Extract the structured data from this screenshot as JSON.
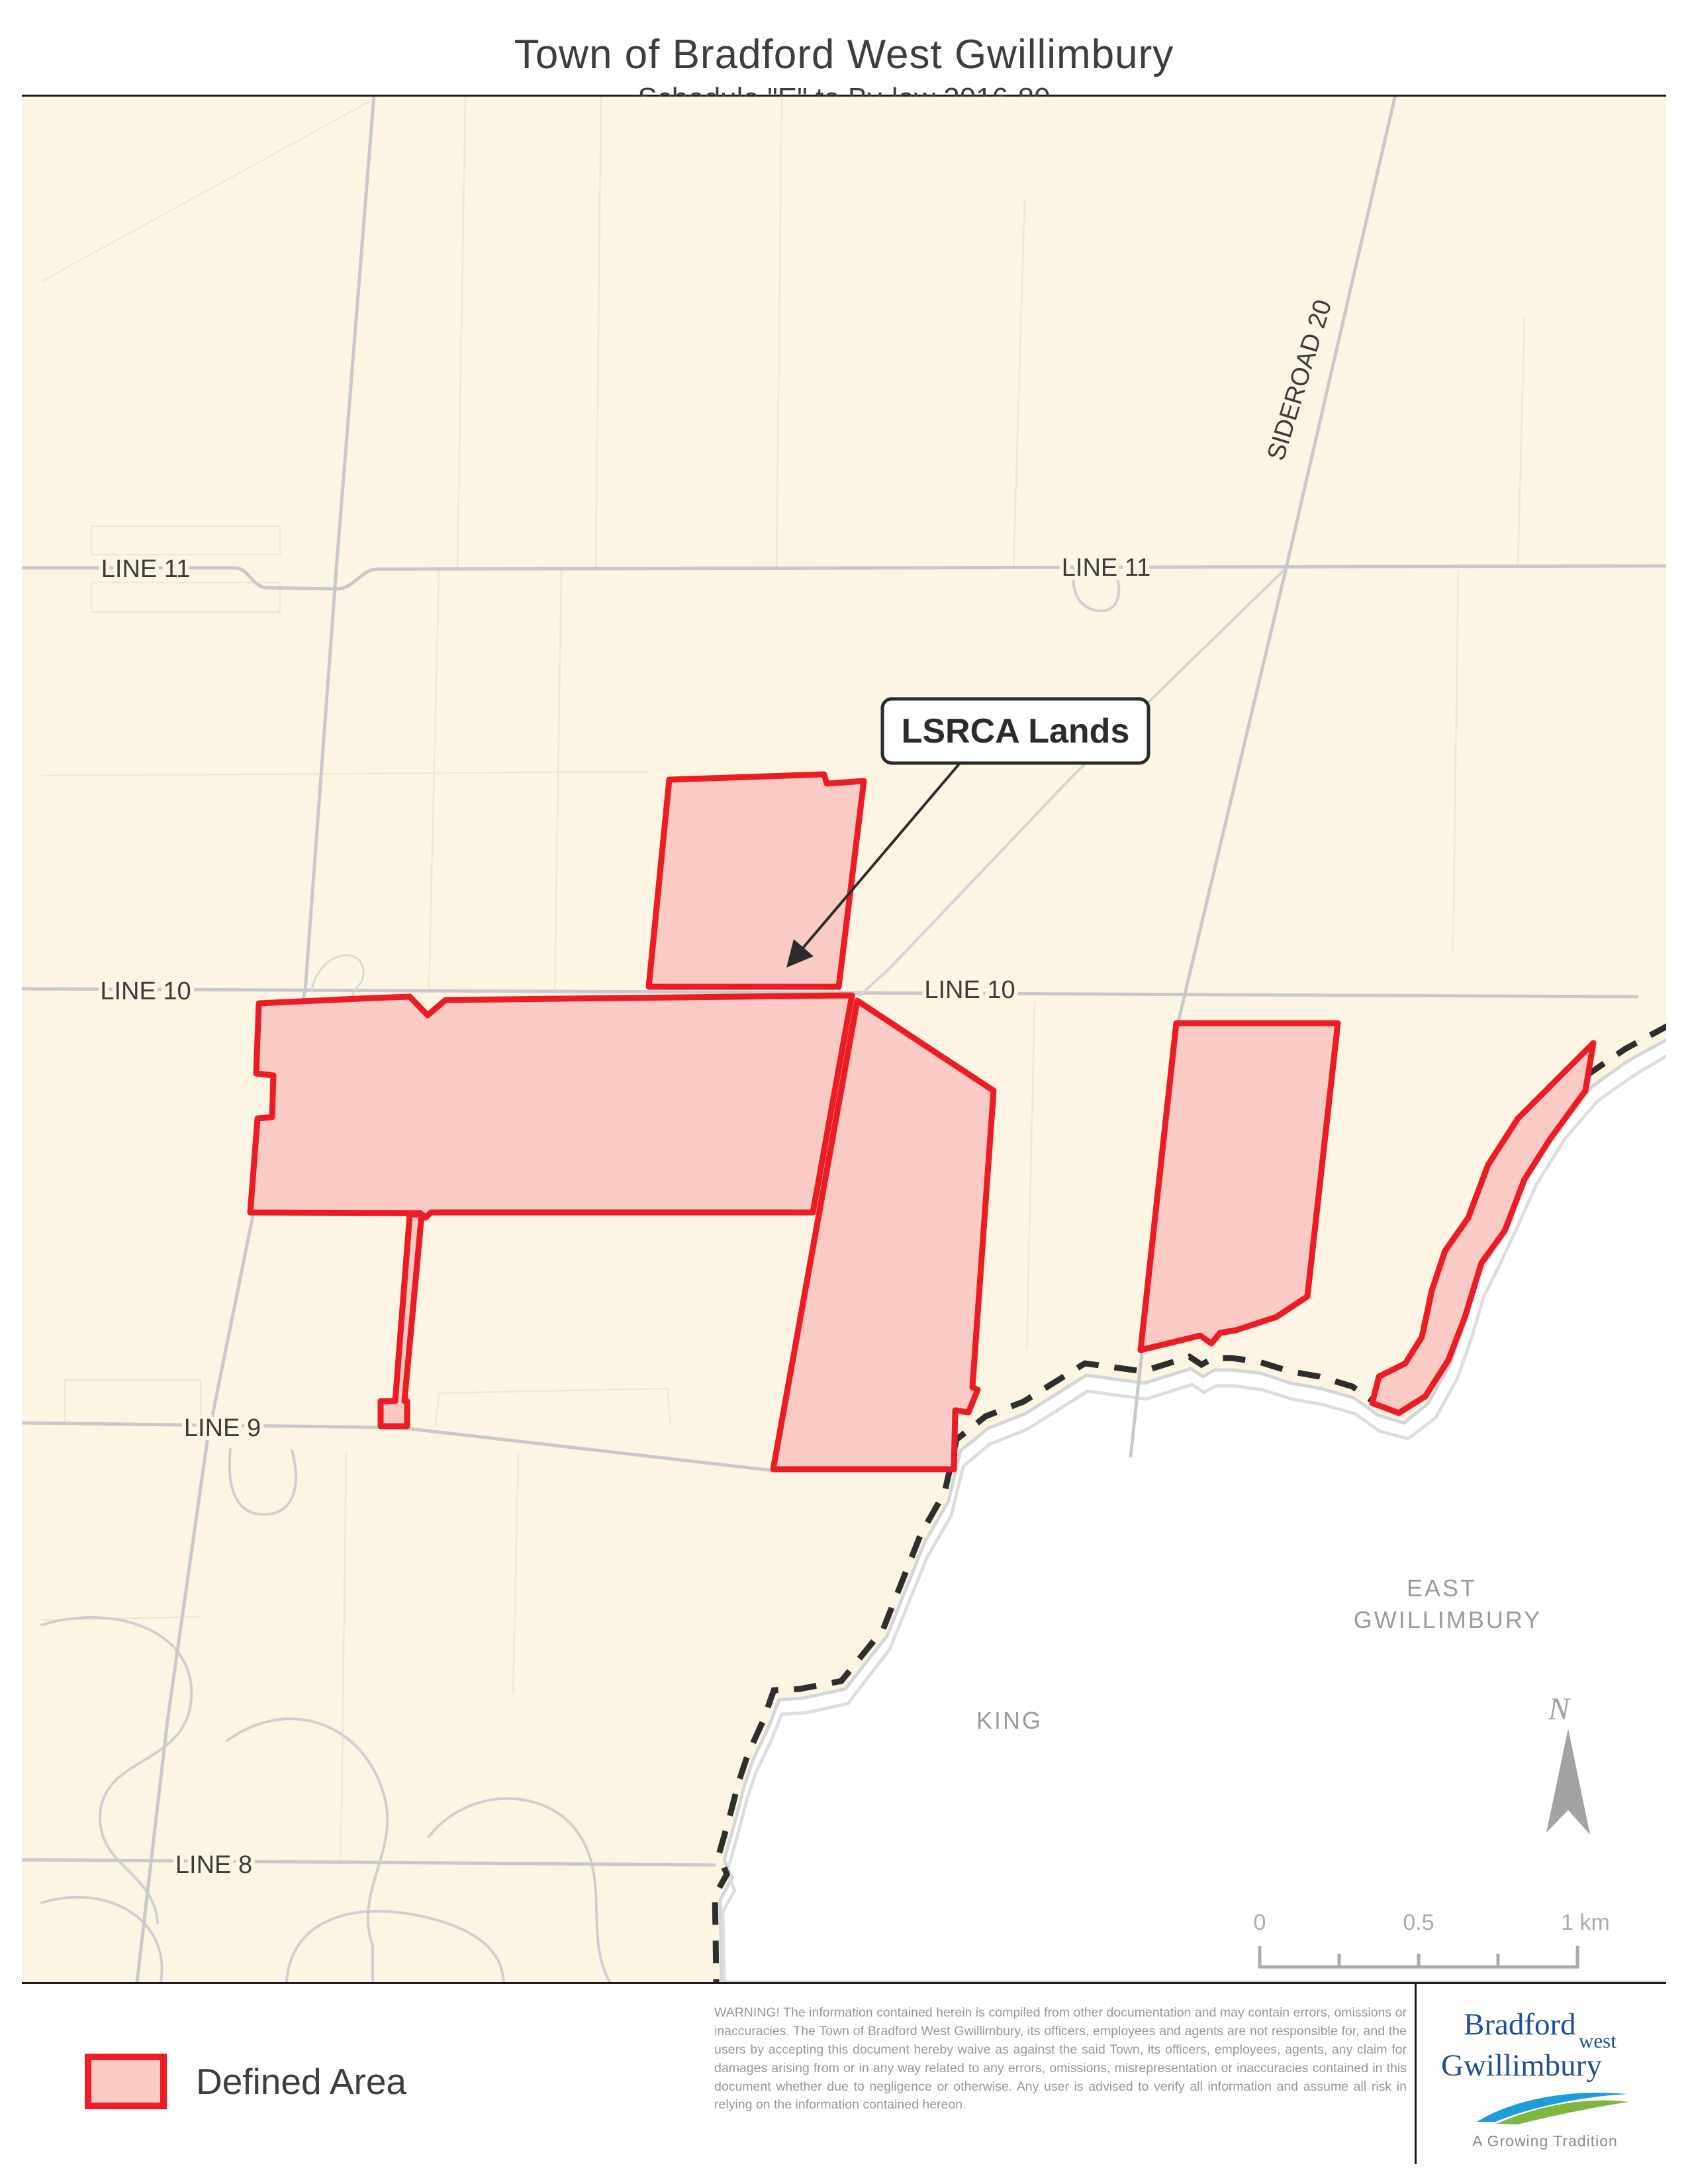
{
  "page": {
    "title": "Town of Bradford West Gwillimbury",
    "subtitle": "Schedule \"E\" to By-law 2016-80"
  },
  "map": {
    "colors": {
      "background": "#FCF5E3",
      "road": "#C9C9C9",
      "road_minor": "#D3D3D3",
      "parcel": "#F0E7D3",
      "red_stroke": "#EC1C24",
      "red_fill": "#F9CBC4",
      "boundary": "#2E2E2E",
      "outside_fill": "#FFFFFF",
      "river": "#D5D5D5"
    },
    "labels": {
      "line11_left": "LINE 11",
      "line11_right": "LINE 11",
      "line10_left": "LINE 10",
      "line10_right": "LINE 10",
      "line9": "LINE 9",
      "line8": "LINE 8",
      "sideroad20": "SIDEROAD 20",
      "east_gwillimbury_line1": "EAST",
      "east_gwillimbury_line2": "GWILLIMBURY",
      "king": "KING",
      "north": "N"
    },
    "callout": {
      "text": "LSRCA Lands"
    },
    "scalebar": {
      "tick0": "0",
      "tick05": "0.5",
      "tick1": "1 km"
    },
    "geo": {
      "outside_region": "2520,1568 2458,1602 2404,1640 2352,1698 2308,1766 2280,1828 2252,1888 2226,1938 2208,2002 2186,2064 2155,2120 2118,2150 2078,2138 2042,2112 1992,2098 1947,2090 1902,2075 1860,2070 1832,2070 1814,2080 1796,2068 1726,2090 1638,2078 1546,2136 1490,2158 1448,2192 1430,2268 1394,2330 1337,2472 1274,2552 1210,2566 1174,2568 1157,2612 1135,2658 1121,2700 1107,2754 1091,2810 1103,2838 1085,2870 1086,2926 1087,2995 2520,2995",
      "river_bank2": "M2520,1592 L2462,1627 L2410,1664 L2360,1722 L2318,1790 L2290,1852 L2262,1912 L2238,1960 L2220,2022 L2198,2084 L2166,2142 L2124,2174 L2080,2162 L2044,2136 L1994,2122 L1949,2114 L1904,2100 L1862,2094 L1834,2094 L1816,2104 L1798,2092 L1728,2114 L1640,2102 L1548,2160 L1492,2182 L1452,2216 L1434,2290 L1398,2352 L1341,2492 L1278,2574 L1214,2588 L1178,2590 L1161,2632 L1139,2678 L1125,2720 L1111,2774 L1095,2830 L1107,2856 L1089,2888 L1090,2942 L1091,2995",
      "boundary_dashed": "M2520,1548 L2452,1585 L2398,1622 L2345,1680 L2300,1748 L2272,1812 L2245,1872 L2218,1922 L2200,1988 L2178,2050 L2148,2105 L2110,2132 L2075,2120 L2040,2095 L1990,2080 L1945,2072 L1900,2058 L1858,2052 L1830,2052 L1812,2062 L1794,2050 L1724,2072 L1636,2060 L1543,2118 L1486,2140 L1442,2175 L1424,2255 L1388,2318 L1331,2462 L1268,2540 L1205,2552 L1166,2554 L1149,2602 L1127,2650 L1113,2692 L1099,2746 L1083,2802 L1095,2832 L1077,2864 L1078,2922 L1079,2995",
      "road_line11": "M30,858 L352,858 C372,858 378,886 398,888 L505,890 C532,890 542,861 566,860 L2520,855",
      "road_line10": "M30,1494 L2470,1506",
      "road_line9": "M30,2150 L600,2157 L1165,2222",
      "road_line8": "M30,2810 L1076,2818",
      "road_left_diagonal": "M562,143 L505,860 L458,1497 L380,1832 L310,2178 L250,2600 L204,2995",
      "road_sideroad20": "M2105,143 L1940,858 L1776,1548 L1720,2062 L1705,2200",
      "road_mid_diagonal": "M1938,860 L1618,1172 L1342,1462 L1296,1504",
      "road_between_polys": "M1290,1510 L1163,2222",
      "road_stream_jog": "M468,1497 C478,1438 542,1428 546,1466 C549,1490 524,1496 532,1506",
      "parcels": [
        "M60,425 L565,148",
        "M700,145 L688,858",
        "M905,145 L897,858",
        "M1178,145 L1170,858",
        "M1545,300 L1528,858",
        "M660,862 L645,1494",
        "M845,862 L835,1494",
        "M2200,862 L2192,1440",
        "M2300,480 L2290,856",
        "M60,1172 L975,1166",
        "M1560,1512 L1548,2040",
        "M520,2195 L512,2808",
        "M780,2195 L772,2560",
        "M60,2448 L298,2443",
        "M655,2155 L660,2105 L1005,2098 L1010,2152",
        "M135,795 L420,795 L420,838 L135,838 Z",
        "M135,880 L420,880 L420,925 L135,925 Z",
        "M95,2085 L300,2085 L300,2152 L95,2152 Z"
      ],
      "urban": [
        "M60,2455 C180,2420 300,2470 285,2575 C272,2668 150,2655 148,2745 C147,2820 230,2830 235,2905",
        "M340,2630 C430,2565 540,2600 575,2705 C605,2795 530,2855 560,2940 L560,2995",
        "M60,2875 C160,2845 255,2900 240,2995",
        "M430,2995 C435,2905 525,2868 645,2898 C765,2928 755,2988 758,2995",
        "M645,2775 C705,2698 825,2700 872,2772 C918,2842 880,2925 918,2995",
        "M1310,2995 C1330,2852 1428,2805 1488,2855 C1548,2905 1525,2988 1565,2995",
        "M1488,2628 C1515,2705 1555,2762 1540,2852",
        "M345,2190 C338,2262 362,2292 402,2288 C442,2284 452,2242 438,2192",
        "M1620,862 C1612,905 1640,928 1668,922 C1690,917 1692,885 1680,862"
      ],
      "poly_top": "1008,1178 1242,1170 1246,1184 1302,1180 1264,1491 977,1491",
      "poly_big_left": "388,1516 560,1508 616,1506 643,1534 670,1511 1284,1504 1225,1832 648,1832 640,1840 632,1833 375,1832 386,1690 408,1688 410,1625 384,1622",
      "poly_stem_square": "M616,1835 L634,1835 L608,2117 L612,2117 L612,2155 L572,2155 L572,2117 L594,2117 Z",
      "poly_middle": "1292,1512 1498,1648 1466,2096 1474,2100 1460,2134 1440,2131 1438,2220 1165,2220",
      "poly_right_parallelogram": "1774,1546 2018,1546 1972,1959 1925,1990 1864,2010 1840,2014 1827,2030 1810,2018 1720,2040",
      "poly_far_right_band": "2404,1576 2392,1648 2338,1722 2300,1782 2270,1860 2235,1908 2210,1990 2185,2055 2150,2110 2110,2135 2070,2120 2080,2080 2120,2060 2145,2020 2160,1950 2180,1890 2215,1840 2245,1760 2290,1690 2340,1640",
      "callout_arrow_line": "M1448,1152 L1206,1437",
      "callout_arrow_head": "1185,1462 1196,1419 1226,1445",
      "north_arrow": "2366,2612 2399,2772 2366,2735 2333,2769",
      "scalebar_lines": "M1900,2940 L1900,2972 L2380,2972 L2380,2940 M2020,2952 L2020,2972 M2140,2952 L2140,2972 M2260,2952 L2260,2972"
    }
  },
  "legend": {
    "defined_area": "Defined Area"
  },
  "footer": {
    "warning": "WARNING!  The information contained herein is compiled from other documentation and may contain errors, omissions or inaccuracies.  The Town of Bradford West Gwillimbury, its officers, employees and agents are not responsible for, and the users by accepting this document hereby waive as against the said Town, its officers, employees, agents, any claim for damages arising from or in any way related to any errors, omissions, misrepresentation or inaccuracies contained in this document whether due to negligence or otherwise.  Any user is advised to verify all information and assume all risk in relying on the information contained hereon.",
    "logo_line1": "Bradford",
    "logo_west": "west",
    "logo_line2": "Gwillimbury",
    "logo_tagline": "A Growing Tradition"
  }
}
